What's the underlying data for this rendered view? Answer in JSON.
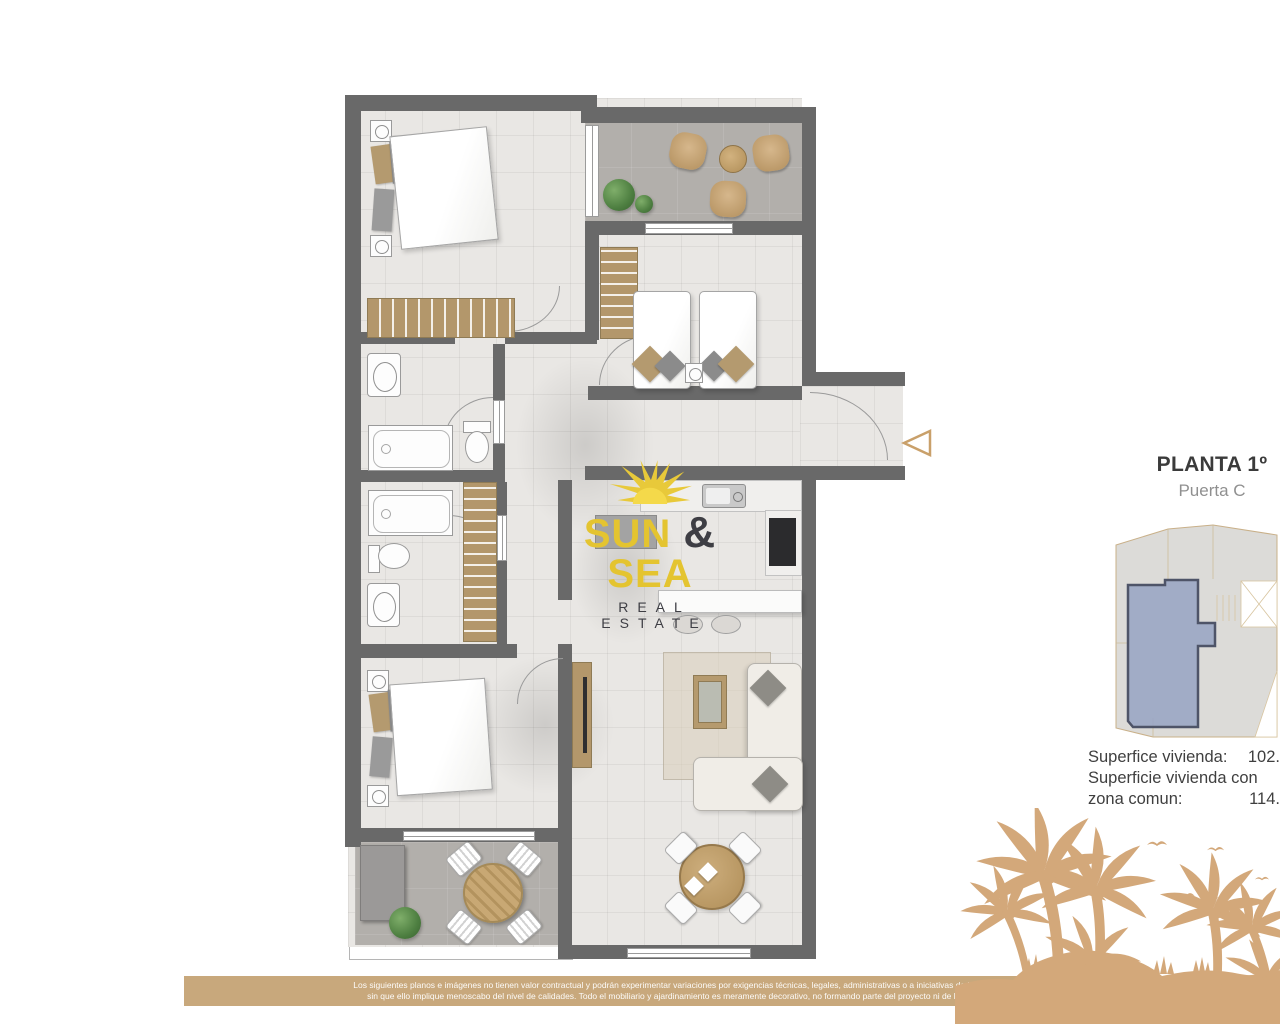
{
  "logo": {
    "word1": "SUN",
    "ampersand": "&",
    "word2": "SEA",
    "tagline": "REAL ESTATE"
  },
  "plan_info": {
    "title": "PLANTA 1º",
    "subtitle": "Puerta C"
  },
  "surface_table": {
    "rows": [
      {
        "label": "Superfice vivienda:",
        "value": "102."
      },
      {
        "label": "Superficie vivienda con",
        "value": ""
      },
      {
        "label": "zona comun:",
        "value": "114."
      }
    ]
  },
  "disclaimer": {
    "line1": "Los siguientes planos e imágenes no tienen valor contractual y podrán experimentar variaciones por exigencias técnicas, legales, administrativas o a iniciativas de los arquitectos directores de las obras",
    "line2": "sin que ello implique menoscabo del nivel de calidades. Todo el mobiliario y ajardinamiento es meramente decorativo, no formando parte del proyecto ni de la memoria de calidades del proyecto."
  },
  "palette": {
    "wall": "#696969",
    "floor_tile": "#e9e7e4",
    "terrace_tile": "#b2afab",
    "wood": "#b3976b",
    "logo_gold": "#e4c430",
    "logo_dark": "#3e3e44",
    "palm_tan": "#d3a87a",
    "disclaimer_bg": "#c8a87c",
    "keyplan_unit_fill": "#9aa6c4",
    "keyplan_unit_stroke": "#4e5468",
    "keyplan_outline": "#c9b089",
    "entrance_marker_stroke": "#c9a06a"
  },
  "icons": {
    "sun": "sun-logo-icon",
    "entrance": "entrance-arrow",
    "palms": "palm-beach-art"
  }
}
